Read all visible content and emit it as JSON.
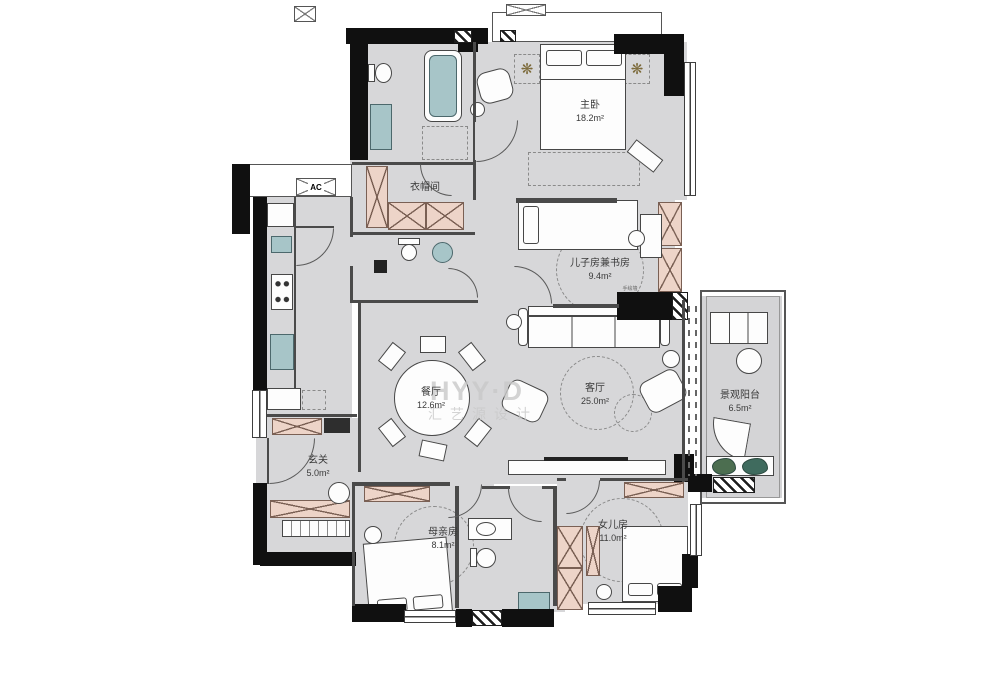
{
  "watermark": {
    "brand": "HYY·D",
    "studio": "汇艺源设计"
  },
  "icons": {
    "plant": "❋"
  },
  "labels": {
    "ac": "AC",
    "wall_note": "手绘墙"
  },
  "rooms": {
    "master_bedroom": {
      "name": "主卧",
      "area": "18.2m²"
    },
    "cloakroom": {
      "name": "衣帽间",
      "area": ""
    },
    "son_study_room": {
      "name": "儿子房兼书房",
      "area": "9.4m²"
    },
    "dining_room": {
      "name": "餐厅",
      "area": "12.6m²"
    },
    "living_room": {
      "name": "客厅",
      "area": "25.0m²"
    },
    "balcony": {
      "name": "景观阳台",
      "area": "6.5m²"
    },
    "entry": {
      "name": "玄关",
      "area": "5.0m²"
    },
    "mother_room": {
      "name": "母亲房",
      "area": "8.1m²"
    },
    "daughter_room": {
      "name": "女儿房",
      "area": "11.0m²"
    }
  },
  "colors": {
    "wall": "#101010",
    "floor": "#d7d7d9",
    "wardrobe_fill": "#edd4c8",
    "fixture_teal": "#a7c5c8",
    "watermark": "#c9c9c9",
    "plant_green": "#4c6e50"
  }
}
